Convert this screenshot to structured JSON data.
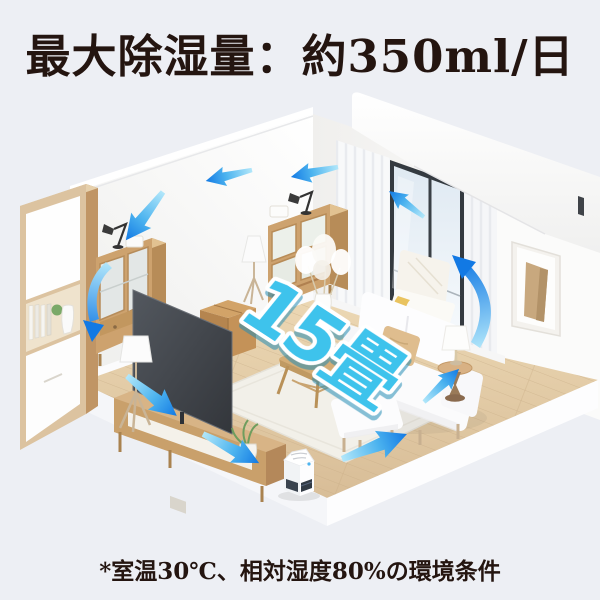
{
  "page": {
    "background": "#edeff4",
    "width": 600,
    "height": 600
  },
  "header": {
    "title": "最大除湿量：約350ml/日",
    "text_color": "#241510"
  },
  "scene": {
    "room_size_label": "15畳",
    "room_size_fill": "#3ec3ec",
    "room_size_outline": "#ffffff",
    "airflow_arrows": {
      "count": 10,
      "gradient_start": "#b2e7fa",
      "gradient_end": "#1279e4",
      "meaning": "air-circulation"
    },
    "palette": {
      "wall": "#ffffff",
      "wall_shade": "#efefed",
      "floor": "#e7d2ae",
      "floor_shade": "#d8bd97",
      "wood": "#c99e6b",
      "rug": "#f2f0e9",
      "window_frame": "#343a40",
      "blanket": "#e9c35f",
      "pillow": "#dfbd8e",
      "leather_pouf": "#c49258"
    },
    "objects": [
      "bookshelf",
      "sideboard",
      "desk-lamp",
      "display-cabinet",
      "pampas-vase",
      "floor-lamp",
      "tv",
      "tv-stand",
      "potted-plant",
      "leather-pouf",
      "rug",
      "coffee-table",
      "sofa",
      "throw-pillow",
      "ottoman",
      "side-table",
      "table-lamp",
      "armchair",
      "throw-blanket",
      "window",
      "curtains",
      "wall-niche",
      "dehumidifier"
    ]
  },
  "footer": {
    "note": "*室温30℃、相対湿度80%の環境条件",
    "text_color": "#241510"
  }
}
